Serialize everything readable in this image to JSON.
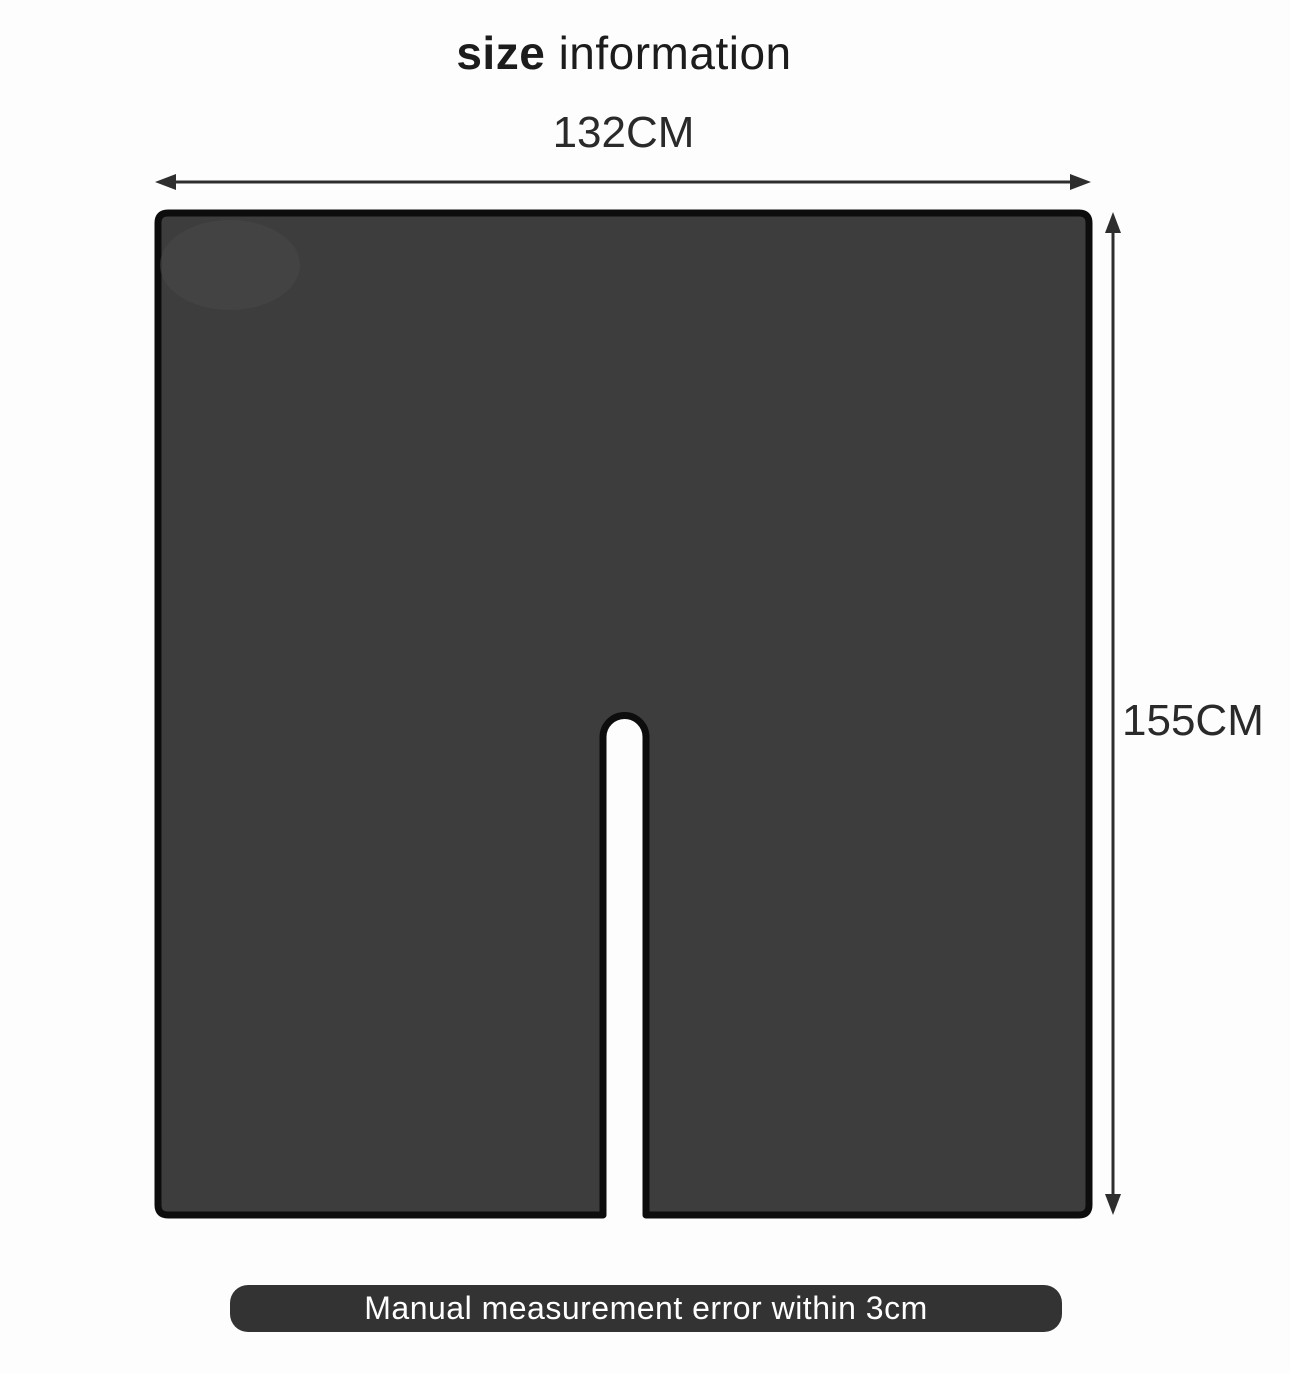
{
  "title": {
    "bold_part": "size",
    "regular_part": " information"
  },
  "diagram": {
    "width_label": "132CM",
    "height_label": "155CM"
  },
  "footer": {
    "note": "Manual measurement error within 3cm"
  },
  "colors": {
    "shape_fill": "#3d3d3d",
    "shape_border": "#0d0d0d",
    "arrow": "#2e2e2e",
    "footer_bg": "#333333",
    "footer_text": "#ffffff",
    "text": "#1c1c1c",
    "background": "#fdfdfd"
  }
}
